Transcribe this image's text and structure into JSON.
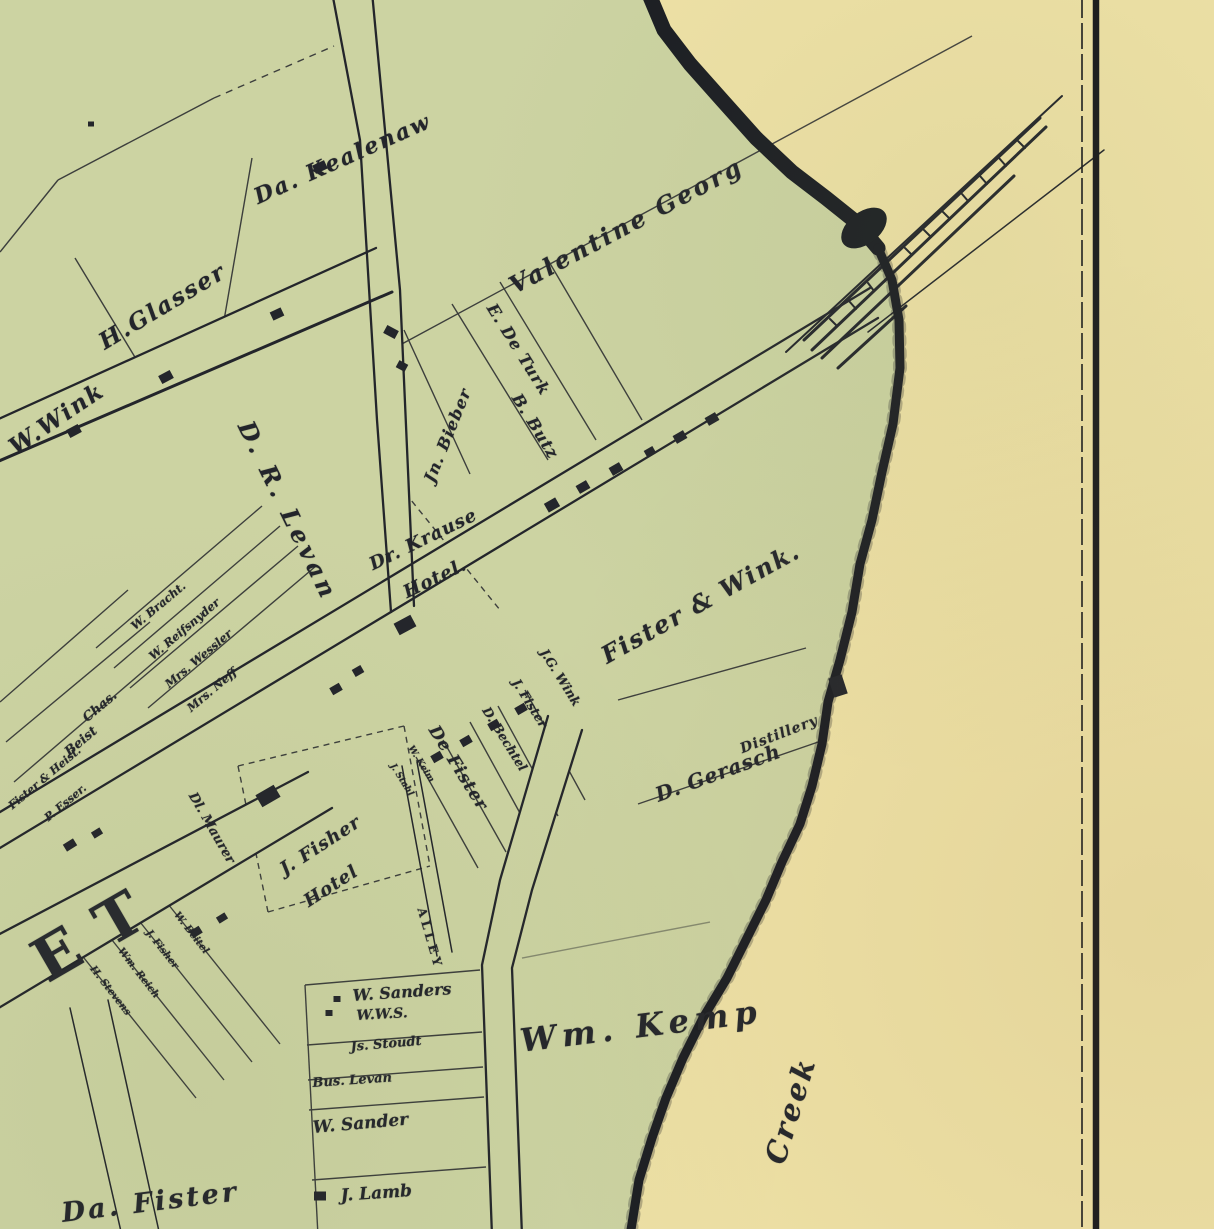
{
  "map": {
    "description": "Vintage village property map with creek, railroad and named parcels",
    "colors": {
      "land": "#ccd3a2",
      "shore": "#eee1a6",
      "ink": "#23252b",
      "creek": "#1b1e23",
      "border": "#17181c"
    },
    "labels": [
      {
        "id": "kealenaw",
        "text": "Da. Kealenaw",
        "x": 250,
        "y": 186,
        "rot": -24,
        "size": 22,
        "ls": 2,
        "kind": "script"
      },
      {
        "id": "valentine-georg",
        "text": "Valentine Georg",
        "x": 504,
        "y": 274,
        "rot": -28,
        "size": 24,
        "ls": 3,
        "kind": "script"
      },
      {
        "id": "h-glasser",
        "text": "H.Glasser",
        "x": 94,
        "y": 332,
        "rot": -31,
        "size": 23,
        "ls": 2,
        "kind": "script"
      },
      {
        "id": "w-wink",
        "text": "W.Wink",
        "x": 4,
        "y": 438,
        "rot": -34,
        "size": 23,
        "ls": 2,
        "kind": "script"
      },
      {
        "id": "d-r-levan",
        "text": "D. R. Levan",
        "x": 258,
        "y": 416,
        "rot": 64,
        "size": 24,
        "ls": 4,
        "kind": "script"
      },
      {
        "id": "jn-bieber",
        "text": "Jn. Bieber",
        "x": 420,
        "y": 478,
        "rot": -68,
        "size": 16,
        "ls": 1,
        "kind": "script"
      },
      {
        "id": "e-de-turk",
        "text": "E. De Turk",
        "x": 499,
        "y": 300,
        "rot": 58,
        "size": 16,
        "ls": 1,
        "kind": "script"
      },
      {
        "id": "b-butz",
        "text": "B. Butz",
        "x": 524,
        "y": 390,
        "rot": 58,
        "size": 16,
        "ls": 1,
        "kind": "script"
      },
      {
        "id": "dr-krause",
        "text": "Dr. Krause",
        "x": 366,
        "y": 556,
        "rot": -26,
        "size": 18,
        "ls": 1,
        "kind": "script"
      },
      {
        "id": "dr-krause-hotel",
        "text": "Hotel.",
        "x": 400,
        "y": 584,
        "rot": -26,
        "size": 18,
        "ls": 1,
        "kind": "script"
      },
      {
        "id": "fister-and-wink",
        "text": "Fister & Wink.",
        "x": 596,
        "y": 644,
        "rot": -29,
        "size": 24,
        "ls": 2,
        "kind": "script"
      },
      {
        "id": "jg-wink",
        "text": "J.G. Wink",
        "x": 550,
        "y": 646,
        "rot": 58,
        "size": 12.5,
        "kind": "script"
      },
      {
        "id": "j-fister",
        "text": "J. Fister",
        "x": 522,
        "y": 676,
        "rot": 58,
        "size": 12.5,
        "kind": "script"
      },
      {
        "id": "d-bechtel",
        "text": "D. Bechtel",
        "x": 492,
        "y": 704,
        "rot": 58,
        "size": 12.5,
        "kind": "script"
      },
      {
        "id": "de-fister",
        "text": "De Fister",
        "x": 441,
        "y": 722,
        "rot": 58,
        "size": 17,
        "ls": 1,
        "kind": "script"
      },
      {
        "id": "w-keim",
        "text": "W. Keim",
        "x": 414,
        "y": 744,
        "rot": 58,
        "size": 9,
        "kind": "script"
      },
      {
        "id": "j-stahl",
        "text": "J. Stahl",
        "x": 396,
        "y": 762,
        "rot": 58,
        "size": 9,
        "kind": "script"
      },
      {
        "id": "distillery",
        "text": "Distillery",
        "x": 738,
        "y": 742,
        "rot": -21,
        "size": 14,
        "ls": 1,
        "kind": "script"
      },
      {
        "id": "d-gerasch",
        "text": "D. Gerasch",
        "x": 652,
        "y": 784,
        "rot": -20,
        "size": 20,
        "ls": 1,
        "kind": "script"
      },
      {
        "id": "j-fisher",
        "text": "J. Fisher",
        "x": 276,
        "y": 862,
        "rot": -33,
        "size": 18,
        "ls": 1,
        "kind": "script"
      },
      {
        "id": "j-fisher-hotel",
        "text": "Hotel",
        "x": 300,
        "y": 894,
        "rot": -33,
        "size": 18,
        "ls": 1,
        "kind": "script"
      },
      {
        "id": "alley",
        "text": "ALLEY",
        "x": 428,
        "y": 906,
        "rot": 74,
        "size": 12,
        "ls": 4,
        "kind": "caps"
      },
      {
        "id": "street-et",
        "text": "ET",
        "x": 20,
        "y": 936,
        "rot": -30,
        "size": 60,
        "ls": 26,
        "kind": "huge"
      },
      {
        "id": "dl-maurer",
        "text": "Dl. Maurer",
        "x": 198,
        "y": 790,
        "rot": 60,
        "size": 13,
        "kind": "script"
      },
      {
        "id": "w-bracht",
        "text": "W. Bracht.",
        "x": 128,
        "y": 622,
        "rot": -40,
        "size": 11.5,
        "kind": "script"
      },
      {
        "id": "w-reifsnyder",
        "text": "W. Reifsnyder",
        "x": 146,
        "y": 652,
        "rot": -40,
        "size": 11.5,
        "kind": "script"
      },
      {
        "id": "mrs-wessler",
        "text": "Mrs. Wessler",
        "x": 162,
        "y": 680,
        "rot": -40,
        "size": 11.5,
        "kind": "script"
      },
      {
        "id": "mrs-neff",
        "text": "Mrs. Neff",
        "x": 184,
        "y": 704,
        "rot": -40,
        "size": 11.5,
        "kind": "script"
      },
      {
        "id": "chas",
        "text": "Chas.",
        "x": 80,
        "y": 714,
        "rot": -40,
        "size": 13,
        "kind": "script"
      },
      {
        "id": "beist",
        "text": "Beist",
        "x": 62,
        "y": 748,
        "rot": -40,
        "size": 13,
        "kind": "script"
      },
      {
        "id": "fister-and-heist",
        "text": "Fister & Heist.",
        "x": 6,
        "y": 802,
        "rot": -40,
        "size": 11,
        "kind": "script"
      },
      {
        "id": "p-esser",
        "text": "P. Esser.",
        "x": 42,
        "y": 814,
        "rot": -40,
        "size": 11,
        "kind": "script"
      },
      {
        "id": "h-stevens",
        "text": "H. Stevens",
        "x": 96,
        "y": 964,
        "rot": 52,
        "size": 10,
        "kind": "script"
      },
      {
        "id": "wm-reich",
        "text": "Wm. Reich",
        "x": 124,
        "y": 946,
        "rot": 52,
        "size": 10,
        "kind": "script"
      },
      {
        "id": "j-fisher-2",
        "text": "J. Fisher",
        "x": 152,
        "y": 928,
        "rot": 52,
        "size": 10,
        "kind": "script"
      },
      {
        "id": "w-beitel",
        "text": "W. Beitel",
        "x": 180,
        "y": 910,
        "rot": 52,
        "size": 10,
        "kind": "script"
      },
      {
        "id": "w-sanders",
        "text": "W. Sanders",
        "x": 352,
        "y": 986,
        "rot": -4,
        "size": 16,
        "kind": "script"
      },
      {
        "id": "wws",
        "text": "W.W.S.",
        "x": 356,
        "y": 1008,
        "rot": -3,
        "size": 14,
        "kind": "script"
      },
      {
        "id": "js-stoudt",
        "text": "Js. Stoudt",
        "x": 350,
        "y": 1040,
        "rot": -5,
        "size": 13,
        "kind": "script"
      },
      {
        "id": "bus-levan",
        "text": "Bus. Levan",
        "x": 312,
        "y": 1076,
        "rot": -4,
        "size": 13,
        "kind": "script"
      },
      {
        "id": "w-sander",
        "text": "W. Sander",
        "x": 312,
        "y": 1118,
        "rot": -5,
        "size": 17,
        "kind": "script"
      },
      {
        "id": "j-lamb",
        "text": "J. Lamb",
        "x": 340,
        "y": 1186,
        "rot": -4,
        "size": 17,
        "kind": "script"
      },
      {
        "id": "wm-kemp",
        "text": "Wm. Kemp",
        "x": 518,
        "y": 1022,
        "rot": -7,
        "size": 32,
        "ls": 6,
        "kind": "script"
      },
      {
        "id": "creek",
        "text": "Creek",
        "x": 758,
        "y": 1158,
        "rot": -73,
        "size": 29,
        "ls": 3,
        "kind": "script"
      },
      {
        "id": "da-fister",
        "text": "Da. Fister",
        "x": 60,
        "y": 1198,
        "rot": -7,
        "size": 27,
        "ls": 3,
        "kind": "script"
      }
    ],
    "buildings": [
      [
        320,
        167,
        13,
        9,
        -25
      ],
      [
        277,
        314,
        12,
        9,
        -25
      ],
      [
        166,
        377,
        13,
        9,
        -28
      ],
      [
        74,
        431,
        13,
        9,
        -28
      ],
      [
        91,
        124,
        6,
        5,
        0
      ],
      [
        391,
        332,
        9,
        13,
        -62
      ],
      [
        402,
        366,
        8,
        10,
        -62
      ],
      [
        552,
        505,
        13,
        10,
        -30
      ],
      [
        583,
        487,
        12,
        9,
        -30
      ],
      [
        616,
        469,
        12,
        9,
        -30
      ],
      [
        650,
        452,
        10,
        8,
        -30
      ],
      [
        680,
        437,
        12,
        9,
        -30
      ],
      [
        712,
        419,
        12,
        9,
        -30
      ],
      [
        405,
        625,
        19,
        13,
        -28
      ],
      [
        336,
        689,
        11,
        8,
        -30
      ],
      [
        358,
        671,
        10,
        8,
        -30
      ],
      [
        437,
        757,
        11,
        8,
        -30
      ],
      [
        466,
        741,
        11,
        8,
        -30
      ],
      [
        494,
        725,
        11,
        8,
        -30
      ],
      [
        521,
        709,
        11,
        8,
        -30
      ],
      [
        268,
        796,
        21,
        14,
        -30
      ],
      [
        838,
        686,
        14,
        20,
        -18
      ],
      [
        337,
        999,
        7,
        6,
        0
      ],
      [
        329,
        1013,
        7,
        6,
        0
      ],
      [
        320,
        1196,
        12,
        9,
        0
      ],
      [
        70,
        845,
        12,
        8,
        -32
      ],
      [
        97,
        833,
        10,
        7,
        -32
      ],
      [
        196,
        932,
        11,
        8,
        -32
      ],
      [
        222,
        918,
        10,
        7,
        -32
      ]
    ]
  }
}
